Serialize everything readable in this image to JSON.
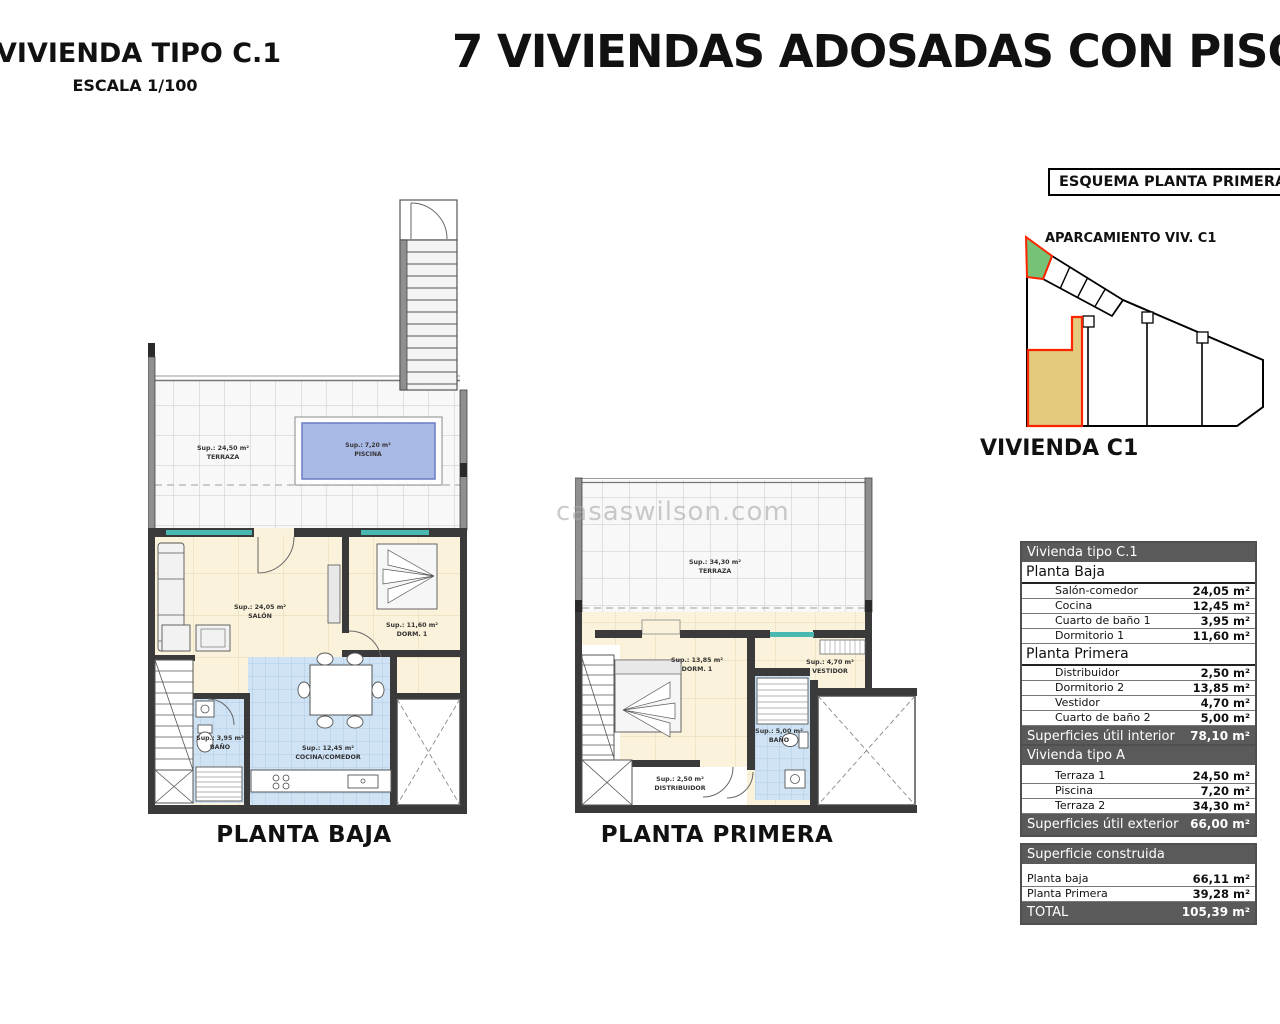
{
  "header": {
    "plan_type_title": "VIVIENDA TIPO C.1",
    "scale": "ESCALA 1/100",
    "main_title": "7 VIVIENDAS ADOSADAS CON PISCINA"
  },
  "watermark": "casaswilson.com",
  "schema": {
    "title": "ESQUEMA PLANTA PRIMERA",
    "parking_label": "APARCAMIENTO VIV. C1",
    "unit_label": "VIVIENDA C1"
  },
  "plans": {
    "planta_baja": {
      "caption": "PLANTA BAJA",
      "rooms": {
        "terraza": {
          "sup": "Sup.: 24,50 m²",
          "name": "TERRAZA"
        },
        "piscina": {
          "sup": "Sup.: 7,20 m²",
          "name": "PISCINA"
        },
        "salon": {
          "sup": "Sup.: 24,05 m²",
          "name": "SALÓN"
        },
        "dorm1": {
          "sup": "Sup.: 11,60 m²",
          "name": "DORM. 1"
        },
        "bano": {
          "sup": "Sup.: 3,95 m²",
          "name": "BAÑO"
        },
        "cocina": {
          "sup": "Sup.: 12,45 m²",
          "name": "COCINA/COMEDOR"
        }
      }
    },
    "planta_primera": {
      "caption": "PLANTA PRIMERA",
      "rooms": {
        "terraza": {
          "sup": "Sup.: 34,30 m²",
          "name": "TERRAZA"
        },
        "dorm": {
          "sup": "Sup.: 13,85 m²",
          "name": "DORM. 1"
        },
        "vestidor": {
          "sup": "Sup.: 4,70 m²",
          "name": "VESTIDOR"
        },
        "bano": {
          "sup": "Sup.: 5,00 m²",
          "name": "BAÑO"
        },
        "distribuidor": {
          "sup": "Sup.: 2,50 m²",
          "name": "DISTRIBUIDOR"
        }
      }
    }
  },
  "tables": {
    "interior": {
      "title": "Vivienda tipo C.1",
      "sections": [
        {
          "label": "Planta Baja",
          "rows": [
            {
              "label": "Salón-comedor",
              "value": "24,05 m²"
            },
            {
              "label": "Cocina",
              "value": "12,45 m²"
            },
            {
              "label": "Cuarto de baño 1",
              "value": "3,95 m²"
            },
            {
              "label": "Dormitorio 1",
              "value": "11,60 m²"
            }
          ]
        },
        {
          "label": "Planta Primera",
          "rows": [
            {
              "label": "Distribuidor",
              "value": "2,50 m²"
            },
            {
              "label": "Dormitorio 2",
              "value": "13,85 m²"
            },
            {
              "label": "Vestidor",
              "value": "4,70 m²"
            },
            {
              "label": "Cuarto de baño 2",
              "value": "5,00 m²"
            }
          ]
        }
      ],
      "footer": {
        "label": "Superficies útil interior",
        "value": "78,10 m²"
      }
    },
    "exterior": {
      "title": "Vivienda tipo A",
      "rows": [
        {
          "label": "Terraza 1",
          "value": "24,50 m²"
        },
        {
          "label": "Piscina",
          "value": "7,20 m²"
        },
        {
          "label": "Terraza 2",
          "value": "34,30 m²"
        }
      ],
      "footer": {
        "label": "Superficies útil exterior",
        "value": "66,00 m²"
      }
    },
    "construida": {
      "title": "Superficie construida",
      "rows": [
        {
          "label": "Planta baja",
          "value": "66,11 m²"
        },
        {
          "label": "Planta Primera",
          "value": "39,28 m²"
        }
      ],
      "footer": {
        "label": "TOTAL",
        "value": "105,39 m²"
      }
    }
  },
  "colors": {
    "wall": "#3a3a3a",
    "cream_floor": "#faf2da",
    "wet_room_blue": "#cfe3f4",
    "pool_blue": "#a9b9e6",
    "window_teal": "#49b8b0",
    "table_header_bg": "#5a5a5a",
    "highlight_red": "#ff2400",
    "parking_green": "#76c276",
    "unit_yellow": "#e3ca7d"
  }
}
